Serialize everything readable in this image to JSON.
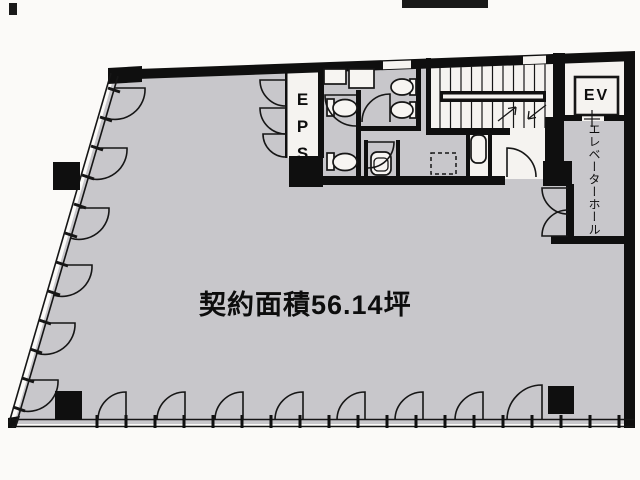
{
  "plan": {
    "area_label": "契約面積56.14坪",
    "eps_label": "EPS",
    "elevator_label": "EV",
    "elevator_hall_label": "エレベーターホール",
    "colors": {
      "floor": "#c8c7cb",
      "wall": "#0f0f0f",
      "room_white": "#f5f3f0",
      "background": "#fbfaf8",
      "line": "#161616"
    }
  }
}
